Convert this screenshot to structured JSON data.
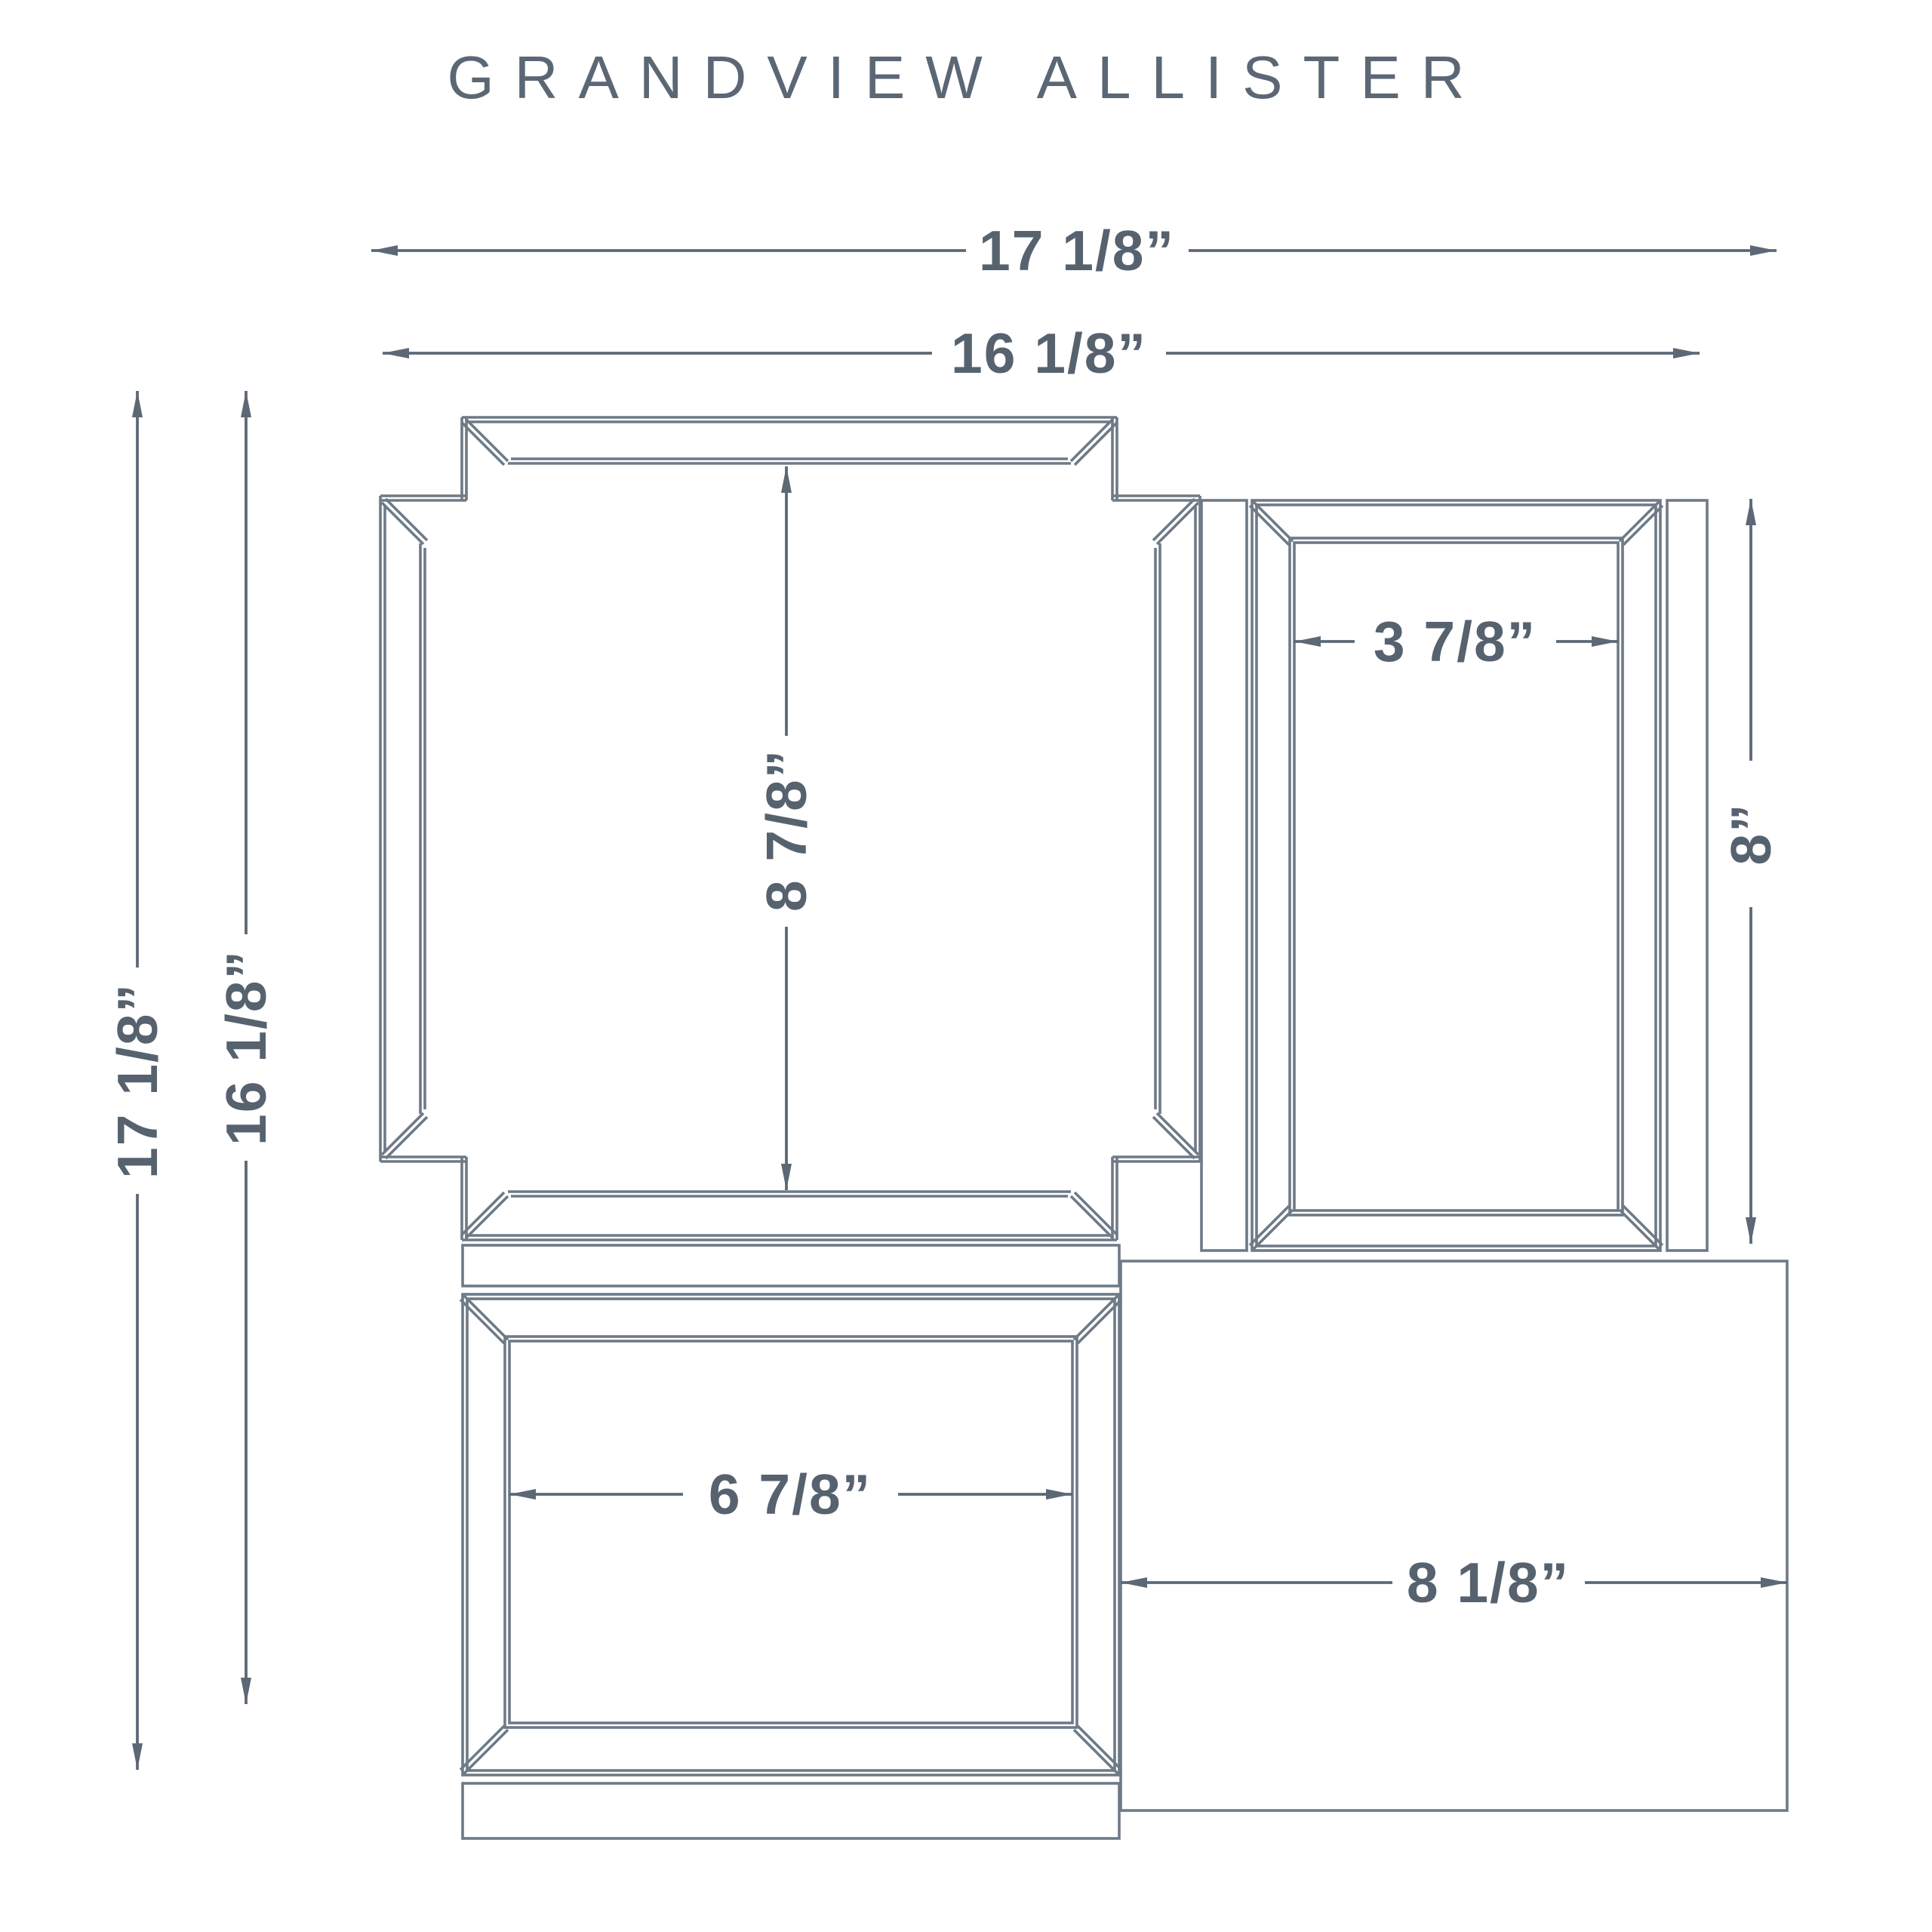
{
  "title": "GRANDVIEW ALLISTER",
  "units": "inches",
  "colors": {
    "background": "#ffffff",
    "drawing_line": "#6E7A86",
    "dimension_line": "#5C6875",
    "text": "#57626F"
  },
  "dimensions": {
    "overall_width": "17 1/8”",
    "inner_width": "16 1/8”",
    "overall_height": "17 1/8”",
    "inner_height": "16 1/8”",
    "main_mirror_opening_height": "8 7/8”",
    "side_mirror_width": "3 7/8”",
    "side_mirror_height": "8”",
    "bottom_mirror_width": "6 7/8”",
    "corner_panel_width": "8 1/8”"
  }
}
